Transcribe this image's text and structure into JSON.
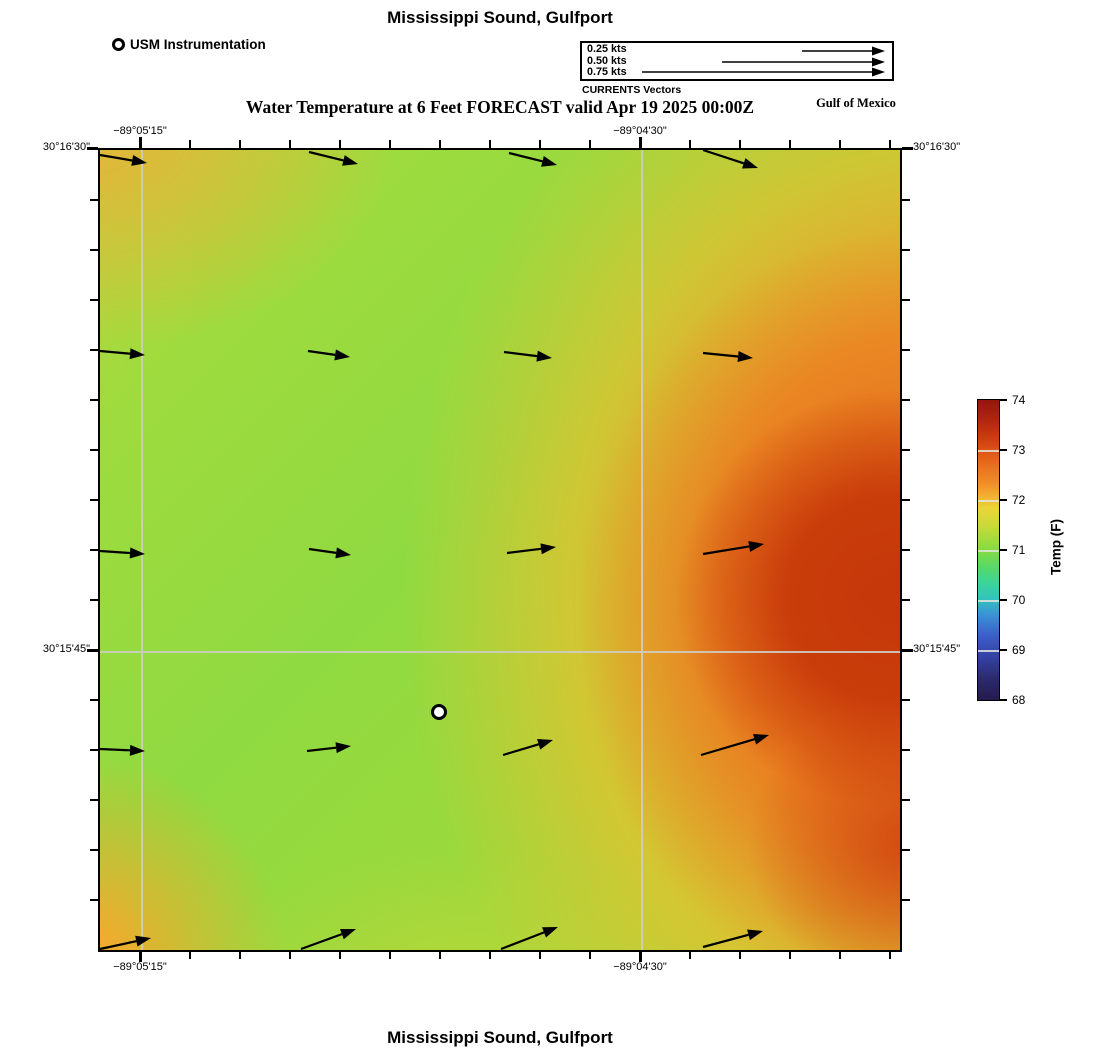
{
  "header": {
    "title": "Mississippi Sound, Gulfport",
    "usm_legend_label": "USM Instrumentation",
    "vector_legend": {
      "items": [
        {
          "label": "0.25 kts"
        },
        {
          "label": "0.50 kts"
        },
        {
          "label": "0.75 kts"
        }
      ],
      "caption": "CURRENTS Vectors",
      "arrows": [
        {
          "x1": 220,
          "y1": 8,
          "x2": 303,
          "y2": 8
        },
        {
          "x1": 140,
          "y1": 19,
          "x2": 303,
          "y2": 19
        },
        {
          "x1": 60,
          "y1": 29,
          "x2": 303,
          "y2": 29
        }
      ]
    },
    "subtitle": "Water Temperature at 6 Feet FORECAST valid Apr 19 2025 00:00Z",
    "region_label": "Gulf of Mexico"
  },
  "map_axis": {
    "top_left": "−89°05'15\"",
    "top_right": "−89°04'30\"",
    "bottom_left": "−89°05'15\"",
    "bottom_right": "−89°04'30\"",
    "left_top": "30°16'30\"",
    "left_mid": "30°15'45\"",
    "right_top": "30°16'30\"",
    "right_mid": "30°15'45\""
  },
  "colorbar": {
    "label": "Temp (F)",
    "tick_labels": [
      "74",
      "73",
      "72",
      "71",
      "70",
      "69",
      "68"
    ]
  },
  "footer": {
    "title": "Mississippi Sound, Gulfport"
  },
  "colors": {
    "field_green": "#90da41",
    "field_gold_left": "#dfb839",
    "field_orange": "#f0962a",
    "field_dark_red": "#c43408",
    "gridline": "#cdcdc4",
    "colorbar_min_navy": "#241a4e",
    "colorbar_max_dark_red": "#96150c"
  },
  "chart_data": {
    "type": "heatmap",
    "title": "Water Temperature at 6 Feet FORECAST valid Apr 19 2025 00:00Z",
    "location": "Mississippi Sound, Gulfport",
    "water_body_label": "Gulf of Mexico",
    "colorbar": {
      "label": "Temp (F)",
      "units": "F",
      "range": [
        68,
        74
      ],
      "ticks": [
        68,
        69,
        70,
        71,
        72,
        73,
        74
      ]
    },
    "x_axis": {
      "kind": "longitude",
      "tick_labels": [
        "−89°05'15\"",
        "−89°04'30\""
      ],
      "gridlines_px": [
        140,
        640
      ]
    },
    "y_axis": {
      "kind": "latitude",
      "tick_labels": [
        "30°16'30\"",
        "30°15'45\""
      ],
      "gridlines_px": [
        148,
        650
      ]
    },
    "temperature_grid_F": {
      "note": "approximate values read from the color field; rows north to south, columns west to east",
      "grid": [
        [
          72.3,
          71.3,
          71.0,
          71.5,
          72.9
        ],
        [
          72.0,
          71.0,
          70.9,
          71.3,
          73.3
        ],
        [
          71.8,
          71.0,
          71.0,
          71.5,
          73.6
        ],
        [
          71.9,
          71.1,
          71.2,
          72.3,
          73.4
        ],
        [
          72.6,
          71.6,
          71.3,
          71.8,
          72.9
        ]
      ]
    },
    "instrument_marker": {
      "label": "USM Instrumentation",
      "x_frac": 0.42,
      "y_frac": 0.7
    },
    "current_vectors": {
      "caption": "CURRENTS Vectors",
      "legend_speeds_kts": [
        0.25,
        0.5,
        0.75
      ],
      "direction": "eastward, tilting slightly down in the north rows and up in the south rows",
      "approx_speed_range_kts": [
        0.13,
        0.21
      ],
      "arrows": [
        {
          "x1": 0,
          "y1": 5,
          "x2": 47,
          "y2": 13
        },
        {
          "x1": 209,
          "y1": 2,
          "x2": 258,
          "y2": 14
        },
        {
          "x1": 409,
          "y1": 3,
          "x2": 457,
          "y2": 15
        },
        {
          "x1": 603,
          "y1": 0,
          "x2": 658,
          "y2": 18
        },
        {
          "x1": 0,
          "y1": 201,
          "x2": 45,
          "y2": 205
        },
        {
          "x1": 208,
          "y1": 201,
          "x2": 250,
          "y2": 207
        },
        {
          "x1": 404,
          "y1": 202,
          "x2": 452,
          "y2": 208
        },
        {
          "x1": 603,
          "y1": 203,
          "x2": 653,
          "y2": 208
        },
        {
          "x1": 0,
          "y1": 401,
          "x2": 45,
          "y2": 404
        },
        {
          "x1": 209,
          "y1": 399,
          "x2": 251,
          "y2": 405
        },
        {
          "x1": 407,
          "y1": 403,
          "x2": 456,
          "y2": 397
        },
        {
          "x1": 603,
          "y1": 404,
          "x2": 664,
          "y2": 394
        },
        {
          "x1": 0,
          "y1": 599,
          "x2": 45,
          "y2": 601
        },
        {
          "x1": 207,
          "y1": 601,
          "x2": 251,
          "y2": 596
        },
        {
          "x1": 403,
          "y1": 605,
          "x2": 453,
          "y2": 590
        },
        {
          "x1": 601,
          "y1": 605,
          "x2": 669,
          "y2": 585
        },
        {
          "x1": 0,
          "y1": 799,
          "x2": 51,
          "y2": 788
        },
        {
          "x1": 201,
          "y1": 799,
          "x2": 256,
          "y2": 779
        },
        {
          "x1": 401,
          "y1": 799,
          "x2": 458,
          "y2": 777
        },
        {
          "x1": 603,
          "y1": 797,
          "x2": 663,
          "y2": 781
        }
      ]
    }
  }
}
